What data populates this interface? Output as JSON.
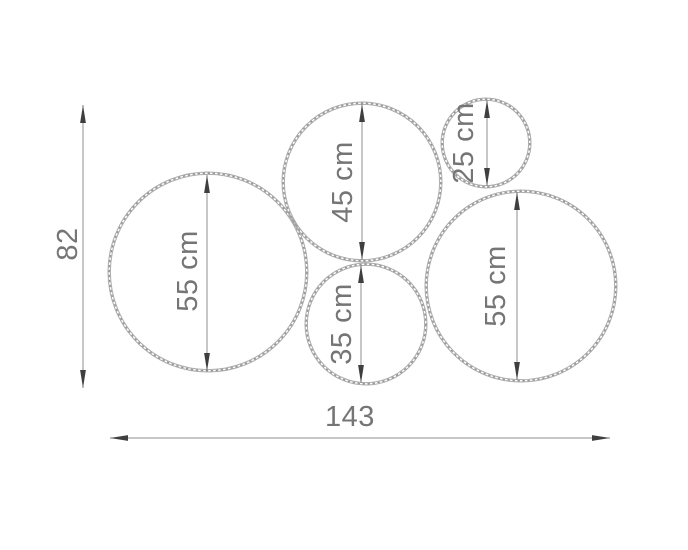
{
  "diagram": {
    "kind": "dimension-drawing",
    "background_color": "#ffffff",
    "ring_color": "#ababab",
    "ring_hatch_color": "#979797",
    "dim_line_color": "#8f8f8f",
    "arrow_color": "#3f3f3f",
    "text_color": "#757575",
    "overall_height": {
      "label": "82"
    },
    "overall_width": {
      "label": "143"
    },
    "circles": [
      {
        "name": "left-large",
        "label": "55 cm"
      },
      {
        "name": "top-middle",
        "label": "45 cm"
      },
      {
        "name": "top-right-small",
        "label": "25 cm"
      },
      {
        "name": "bottom-middle",
        "label": "35 cm"
      },
      {
        "name": "right-large",
        "label": "55 cm"
      }
    ]
  }
}
